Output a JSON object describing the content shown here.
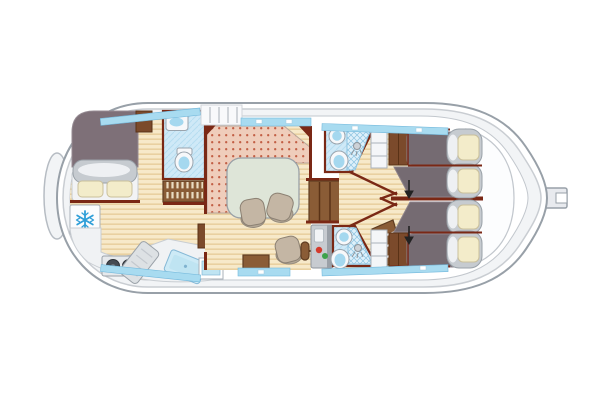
{
  "meta": {
    "type": "boat-floor-plan",
    "canvas": {
      "width": 600,
      "height": 400
    }
  },
  "colors": {
    "background": "#ffffff",
    "hull_outline": "#98a0a8",
    "hull_fill": "#ffffff",
    "hull_shadow": "#f2f4f6",
    "wall": "#7a2815",
    "window_strip": "#a8dbf0",
    "wood_floor": "#f7e9c9",
    "wood_stripe": "#e9d0a0",
    "bathroom_floor": "#cfe9f7",
    "shower_floor": "#def0fa",
    "sofa_pink": "#efcdbb",
    "sofa_dot": "#c25f45",
    "table": "#dee5d8",
    "chair": "#c4b6a4",
    "bed_blanket": "#756b72",
    "bed_cover": "#c6cbd0",
    "pillow": "#f3ecca",
    "wood_furniture": "#8a5c36",
    "door": "#7b4a2b",
    "panel": "#c7cbd0",
    "button_red": "#d43a2c",
    "button_green": "#3da24b",
    "snowflake": "#2f9fd8",
    "sink_blue": "#bfe4f2",
    "arrow": "#222222"
  },
  "icons": {
    "freezer": "snowflake-icon",
    "bed_slide": "arrow-down-icon"
  },
  "rooms": {
    "aft_cabin": {
      "features": [
        "double-bed",
        "freezer",
        "stove-2-burners",
        "drainboard",
        "galley-sink",
        "wardrobe-door"
      ]
    },
    "aft_bathroom": {
      "features": [
        "vanity-washbasin",
        "toilet",
        "storage-shelf"
      ]
    },
    "salon": {
      "features": [
        "l-shaped-sofa",
        "dining-table",
        "chair",
        "chair",
        "helm-seat",
        "steering-tiller",
        "control-panel",
        "companionway-stairs",
        "storage-chest",
        "side-counter"
      ]
    },
    "bow_section": {
      "features": [
        "single-bed",
        "single-bed",
        "single-bed",
        "single-bed",
        "bathroom-with-shower",
        "bathroom-with-shower",
        "wardrobe",
        "wardrobe",
        "cabinet",
        "cabinet",
        "y-corridor",
        "slide-arrow",
        "slide-arrow",
        "aft-deck-steps"
      ]
    }
  }
}
